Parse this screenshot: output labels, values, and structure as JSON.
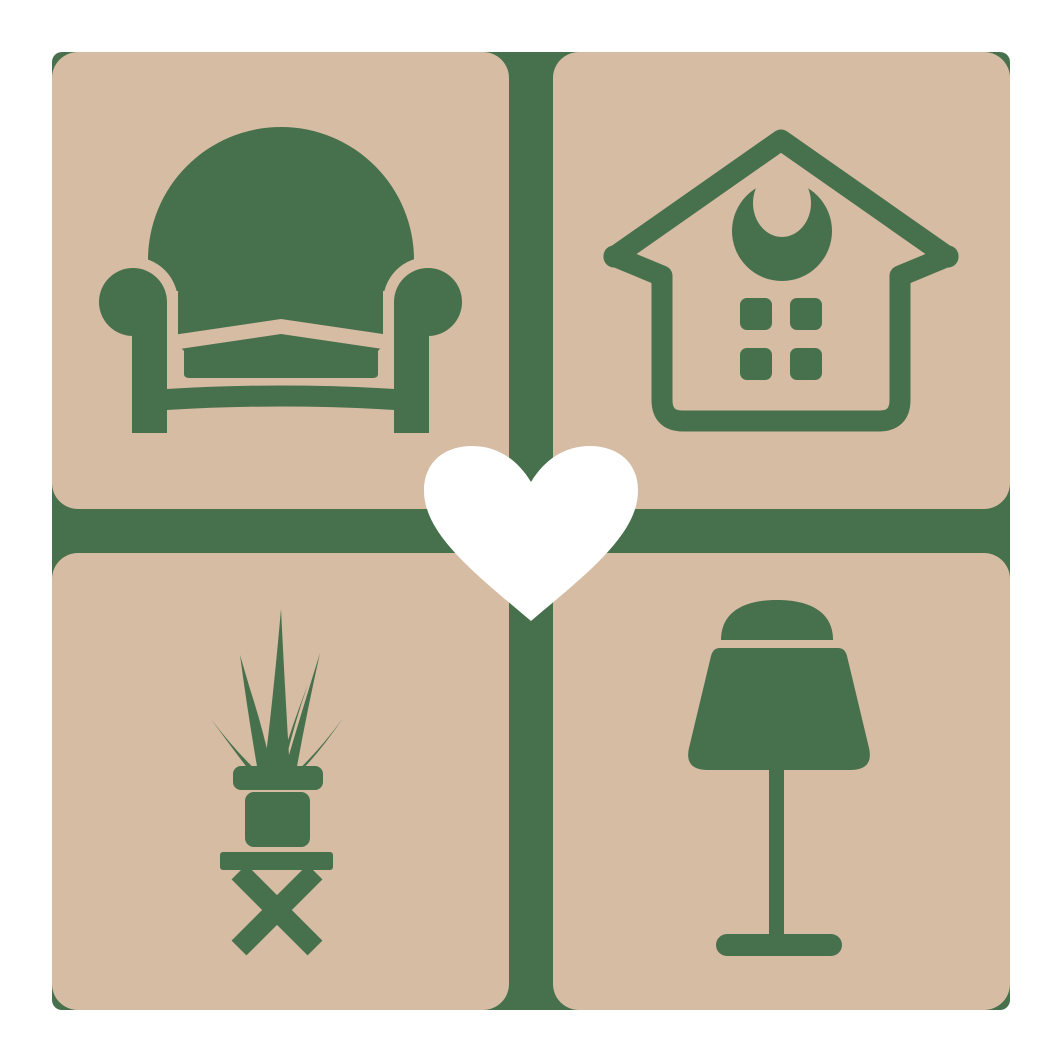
{
  "logo": {
    "type": "furniture-home-logo",
    "colors": {
      "green": "#47704d",
      "tan": "#d5bca3",
      "white": "#ffffff",
      "page": "#ffffff"
    },
    "grid": {
      "background": "green-rounded-square",
      "tiles": [
        {
          "position": "top-left",
          "icon": "armchair-icon"
        },
        {
          "position": "top-right",
          "icon": "house-icon"
        },
        {
          "position": "bottom-left",
          "icon": "potted-plant-on-stool-icon"
        },
        {
          "position": "bottom-right",
          "icon": "table-lamp-icon"
        }
      ],
      "center": {
        "icon": "heart-icon"
      }
    }
  }
}
